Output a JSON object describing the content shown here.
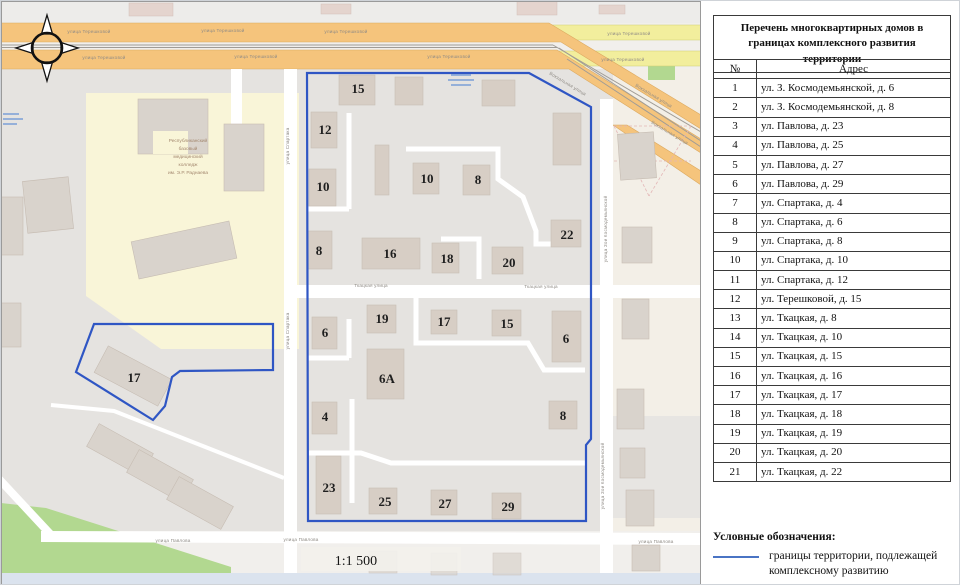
{
  "colors": {
    "boundary_blue": "#2f56c4",
    "legend_line_blue": "#4a74c4",
    "road_orange": "#f5c47c",
    "road_orange_edge": "#dca95f",
    "road_yellow": "#f2ee9d",
    "park_green": "#b2d890",
    "building_tan": "#d7cec5",
    "building_gray": "#d9d3cc",
    "block_gray": "#e5e3e0",
    "college_yellow": "#f9f5d8",
    "water_bar": "#dbe3ee"
  },
  "table": {
    "title": "Перечень многоквартирных домов в границах комплексного развития территории",
    "headers": {
      "num": "№",
      "addr": "Адрес"
    },
    "rows": [
      [
        "1",
        "ул. З. Космодемьянской, д. 6"
      ],
      [
        "2",
        "ул. З. Космодемьянской, д. 8"
      ],
      [
        "3",
        "ул. Павлова, д. 23"
      ],
      [
        "4",
        "ул. Павлова, д. 25"
      ],
      [
        "5",
        "ул. Павлова, д. 27"
      ],
      [
        "6",
        "ул. Павлова, д. 29"
      ],
      [
        "7",
        "ул. Спартака, д. 4"
      ],
      [
        "8",
        "ул. Спартака, д. 6"
      ],
      [
        "9",
        "ул. Спартака, д. 8"
      ],
      [
        "10",
        "ул. Спартака, д. 10"
      ],
      [
        "11",
        "ул. Спартака, д. 12"
      ],
      [
        "12",
        "ул. Терешковой, д. 15"
      ],
      [
        "13",
        "ул. Ткацкая, д. 8"
      ],
      [
        "14",
        "ул. Ткацкая, д. 10"
      ],
      [
        "15",
        "ул. Ткацкая, д. 15"
      ],
      [
        "16",
        "ул. Ткацкая, д. 16"
      ],
      [
        "17",
        "ул. Ткацкая, д. 17"
      ],
      [
        "18",
        "ул. Ткацкая, д. 18"
      ],
      [
        "19",
        "ул. Ткацкая, д. 19"
      ],
      [
        "20",
        "ул. Ткацкая, д. 20"
      ],
      [
        "21",
        "ул. Ткацкая, д. 22"
      ]
    ]
  },
  "legend": {
    "heading": "Условные обозначения:",
    "boundary_label": "границы территории, подлежащей комплексному развитию"
  },
  "map": {
    "scale": "1:1 500",
    "building_labels": [
      {
        "t": "15",
        "x": 357,
        "y": 92
      },
      {
        "t": "12",
        "x": 324,
        "y": 133
      },
      {
        "t": "10",
        "x": 322,
        "y": 190
      },
      {
        "t": "10",
        "x": 426,
        "y": 182
      },
      {
        "t": "8",
        "x": 477,
        "y": 183
      },
      {
        "t": "22",
        "x": 566,
        "y": 238
      },
      {
        "t": "8",
        "x": 318,
        "y": 254
      },
      {
        "t": "16",
        "x": 389,
        "y": 257
      },
      {
        "t": "18",
        "x": 446,
        "y": 262
      },
      {
        "t": "20",
        "x": 508,
        "y": 266
      },
      {
        "t": "6",
        "x": 324,
        "y": 336
      },
      {
        "t": "19",
        "x": 381,
        "y": 322
      },
      {
        "t": "17",
        "x": 443,
        "y": 325
      },
      {
        "t": "15",
        "x": 506,
        "y": 327
      },
      {
        "t": "6",
        "x": 565,
        "y": 342
      },
      {
        "t": "6А",
        "x": 386,
        "y": 382,
        "fs": 15
      },
      {
        "t": "4",
        "x": 324,
        "y": 420
      },
      {
        "t": "8",
        "x": 562,
        "y": 419
      },
      {
        "t": "23",
        "x": 328,
        "y": 491
      },
      {
        "t": "25",
        "x": 384,
        "y": 505
      },
      {
        "t": "27",
        "x": 444,
        "y": 507
      },
      {
        "t": "29",
        "x": 507,
        "y": 510
      },
      {
        "t": "17",
        "x": 133,
        "y": 381
      }
    ],
    "street_labels": [
      {
        "t": "улица Терешковой",
        "x": 88,
        "y": 32
      },
      {
        "t": "улица Терешковой",
        "x": 222,
        "y": 31
      },
      {
        "t": "улица Терешковой",
        "x": 345,
        "y": 32
      },
      {
        "t": "улица Терешковой",
        "x": 628,
        "y": 34
      },
      {
        "t": "улица Терешковой",
        "x": 103,
        "y": 58
      },
      {
        "t": "улица Терешковой",
        "x": 255,
        "y": 57
      },
      {
        "t": "улица Терешковой",
        "x": 448,
        "y": 57
      },
      {
        "t": "улица Терешковой",
        "x": 622,
        "y": 60
      },
      {
        "t": "Вокзальная улица",
        "x": 566,
        "y": 84,
        "r": 31
      },
      {
        "t": "Вокзальная улица",
        "x": 652,
        "y": 96,
        "r": 31
      },
      {
        "t": "Вокзальная улица",
        "x": 668,
        "y": 133,
        "r": 31
      },
      {
        "t": "улица Спартака",
        "x": 288,
        "y": 145,
        "r": -90
      },
      {
        "t": "улица Спартака",
        "x": 288,
        "y": 330,
        "r": -90
      },
      {
        "t": "Ткацкая улица",
        "x": 370,
        "y": 286
      },
      {
        "t": "Ткацкая улица",
        "x": 540,
        "y": 287
      },
      {
        "t": "улица Павлова",
        "x": 172,
        "y": 541
      },
      {
        "t": "улица Павлова",
        "x": 300,
        "y": 540
      },
      {
        "t": "улица Павлова",
        "x": 655,
        "y": 542
      },
      {
        "t": "улица Зои Космодемьянской",
        "x": 606,
        "y": 228,
        "r": -90
      },
      {
        "t": "улица Зои Космодемьянской",
        "x": 603,
        "y": 475,
        "r": -90
      }
    ],
    "poi_label_lines": [
      "Республиканский",
      "базовый",
      "медицинский",
      "колледж",
      "им. Э.Р. Раднаева"
    ]
  }
}
